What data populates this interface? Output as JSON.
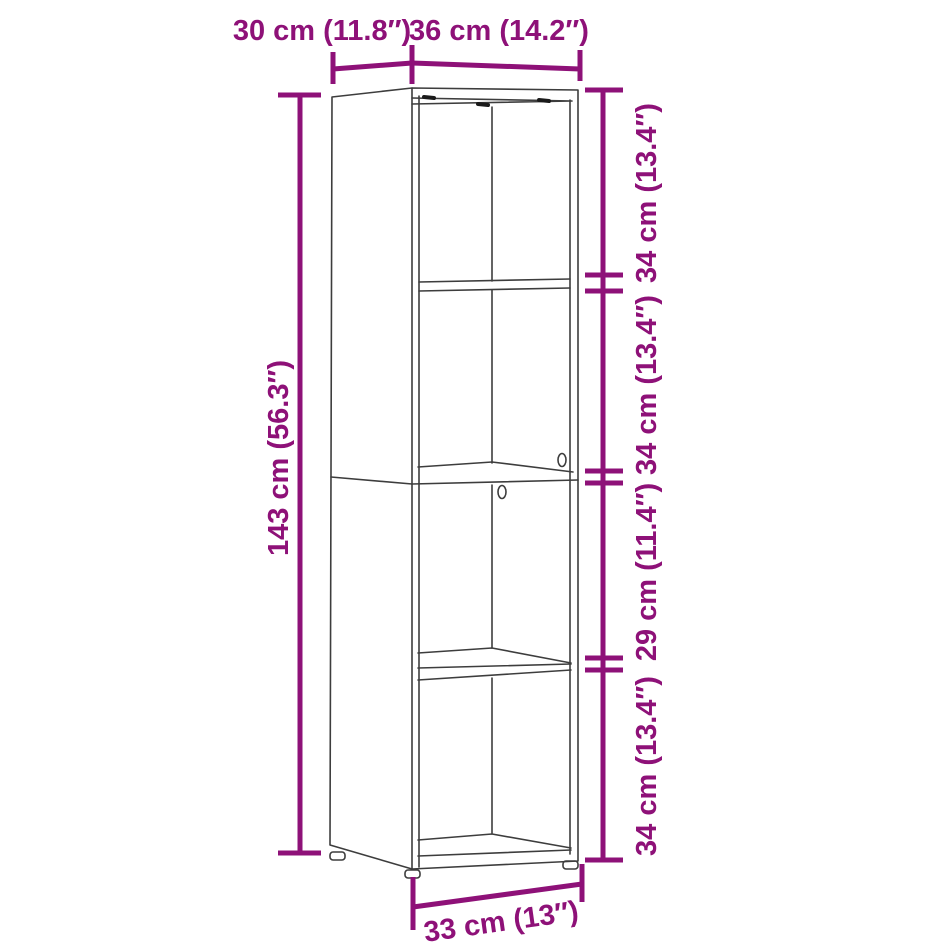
{
  "diagram": {
    "name": "cabinet-dimension-diagram",
    "product": "4-tier bookcase / storage cabinet line drawing",
    "colors": {
      "dimension": "#8E1178",
      "outline": "#3d3d3d",
      "hardware_mark": "#1a1a1a",
      "background": "#ffffff"
    },
    "dimensions": {
      "depth_top": "30 cm (11.8″)",
      "width_top": "36 cm (14.2″)",
      "height_left": "143 cm (56.3″)",
      "right_segments": [
        "34 cm (13.4″)",
        "34 cm (13.4″)",
        "29 cm (11.4″)",
        "34 cm (13.4″)"
      ],
      "width_bottom": "33 cm (13″)"
    }
  }
}
